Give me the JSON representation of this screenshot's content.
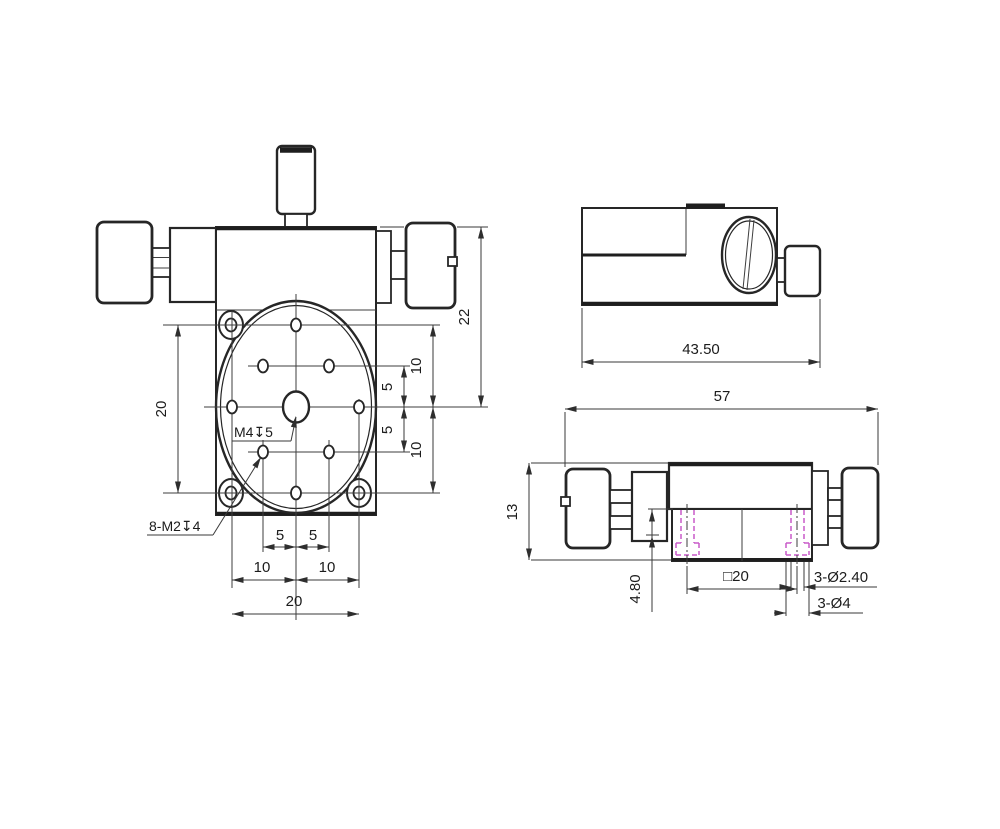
{
  "drawing_title": "XY linear stage dimension drawing",
  "colors": {
    "background": "#ffffff",
    "object_line": "#262626",
    "dimension_line": "#3a3a3a",
    "hidden_hole_line": "#c85ac8"
  },
  "front_view": {
    "dim_overall_height": "22",
    "dim_hole_span_vertical": "20",
    "dim_top_row_to_center": "10",
    "dim_upper_diag_to_center": "5",
    "dim_center_to_lower_diag": "5",
    "dim_center_to_bottom_row": "10",
    "dim_bottom_left_5": "5",
    "dim_bottom_right_5": "5",
    "dim_bottom_left_10": "10",
    "dim_bottom_right_10": "10",
    "dim_hole_span_horizontal": "20",
    "label_center_hole": "M4↧5",
    "label_pattern_holes": "8-M2↧4"
  },
  "side_view_top": {
    "dim_body_length": "43.50"
  },
  "side_view_bottom": {
    "dim_overall_length": "57",
    "dim_body_height": "13",
    "dim_hole_offset": "4.80",
    "dim_mount_square": "□20",
    "dim_through_holes": "3-Ø2.40",
    "dim_counterbores": "3-Ø4"
  }
}
